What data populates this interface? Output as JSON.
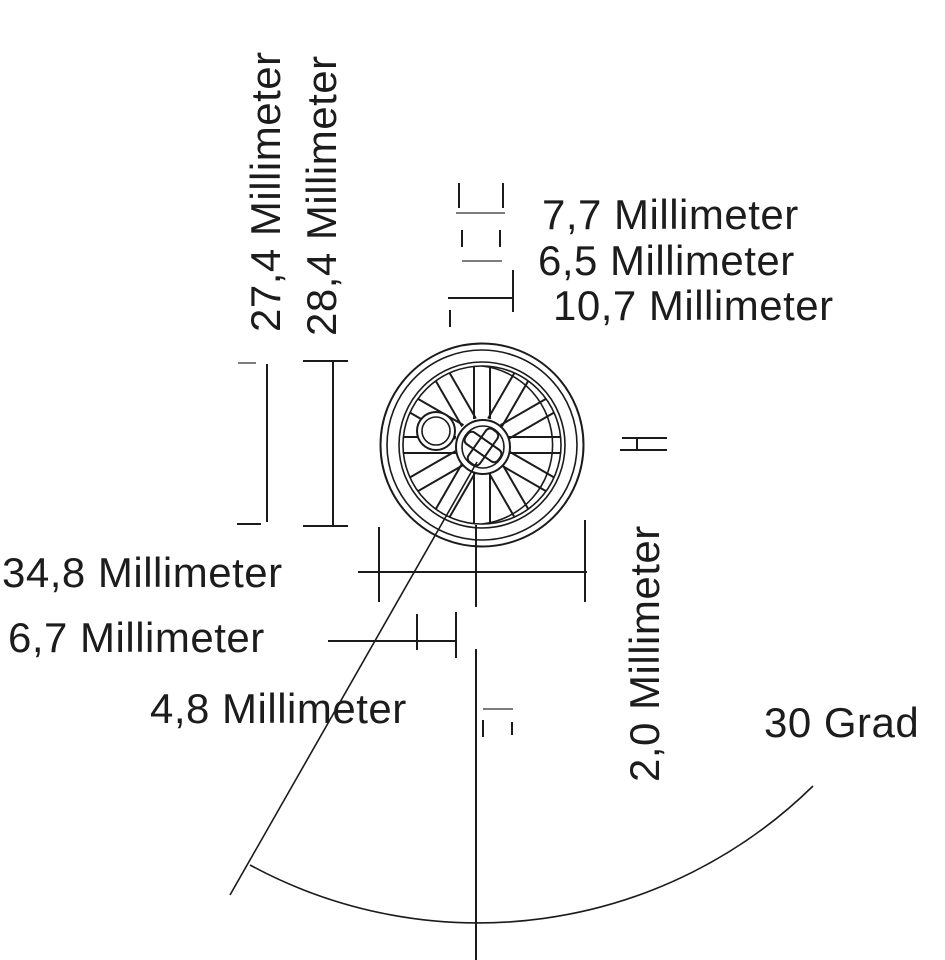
{
  "drawing": {
    "subject": "spoked-wheel-technical-drawing",
    "labels": {
      "d27_4": "27,4 Millimeter",
      "d28_4": "28,4 Millimeter",
      "d7_7": "7,7 Millimeter",
      "d6_5": "6,5 Millimeter",
      "d10_7": "10,7 Millimeter",
      "d34_8": "34,8 Millimeter",
      "d6_7": "6,7 Millimeter",
      "d4_8": "4,8 Millimeter",
      "d2_0": "2,0 Millimeter",
      "a30": "30 Grad"
    },
    "measurements": [
      {
        "value": "27,4",
        "unit": "Millimeter",
        "orientation": "vertical"
      },
      {
        "value": "28,4",
        "unit": "Millimeter",
        "orientation": "vertical"
      },
      {
        "value": "7,7",
        "unit": "Millimeter",
        "orientation": "horizontal"
      },
      {
        "value": "6,5",
        "unit": "Millimeter",
        "orientation": "horizontal"
      },
      {
        "value": "10,7",
        "unit": "Millimeter",
        "orientation": "horizontal"
      },
      {
        "value": "34,8",
        "unit": "Millimeter",
        "orientation": "horizontal"
      },
      {
        "value": "6,7",
        "unit": "Millimeter",
        "orientation": "horizontal"
      },
      {
        "value": "4,8",
        "unit": "Millimeter",
        "orientation": "horizontal"
      },
      {
        "value": "2,0",
        "unit": "Millimeter",
        "orientation": "vertical"
      },
      {
        "value": "30",
        "unit": "Grad",
        "orientation": "angle"
      }
    ],
    "colors": {
      "line": "#1b1b1b",
      "line_light": "#7d7d7d",
      "background": "#ffffff",
      "text": "#1c1c1c"
    }
  }
}
